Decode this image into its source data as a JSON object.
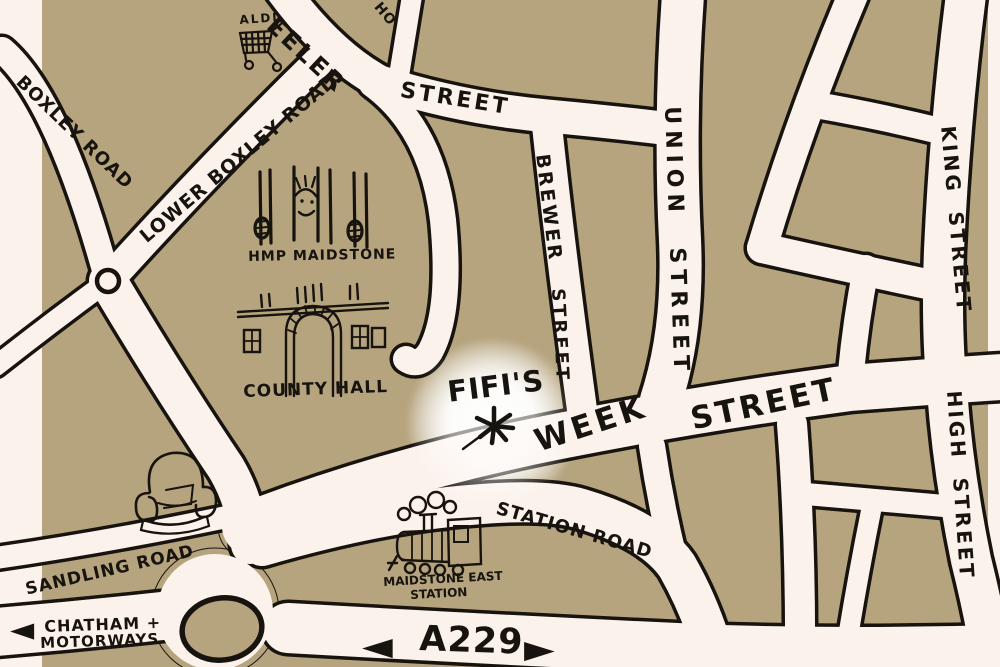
{
  "map": {
    "colors": {
      "land": "#b6a47e",
      "road": "#fcf2ec",
      "ink": "#17130e",
      "highlight_glow": "#ffffff"
    },
    "streets": {
      "boxley_road": "BOXLEY ROAD",
      "lower_boxley_road": "LOWER BOXLEY ROAD",
      "wheeler_street_part1": "EELER",
      "wheeler_street_part2": "STREET",
      "ho_street_partial": "HO",
      "brewer_street_word1": "BREWER",
      "brewer_street_word2": "STREET",
      "union_street": "UNION STREET",
      "king_street": "KING STREET",
      "high_street": "HIGH STREET",
      "week_street_word1": "WEEK",
      "week_street_word2": "STREET",
      "station_road": "STATION ROAD",
      "sandling_road": "SANDLING ROAD",
      "a229": "A229"
    },
    "directions": {
      "chatham_line1": "CHATHAM +",
      "chatham_line2": "MOTORWAYS",
      "west_arrow": "◀",
      "east_arrow": "▶"
    },
    "landmarks": {
      "aldi": "ALDI",
      "hmp_maidstone": "HMP MAIDSTONE",
      "county_hall": "COUNTY HALL",
      "fifis": "FIFI'S",
      "station_line1": "MAIDSTONE EAST",
      "station_line2": "STATION"
    },
    "icons": {
      "aldi": "shopping-cart-icon",
      "hmp_maidstone": "prisoner-behind-bars-icon",
      "county_hall": "arched-building-icon",
      "fifis": "star-marker-icon",
      "armchair": "armchair-icon",
      "station": "steam-train-icon",
      "mini_roundabout": "mini-roundabout-icon",
      "roundabout": "roundabout-island-icon"
    }
  }
}
